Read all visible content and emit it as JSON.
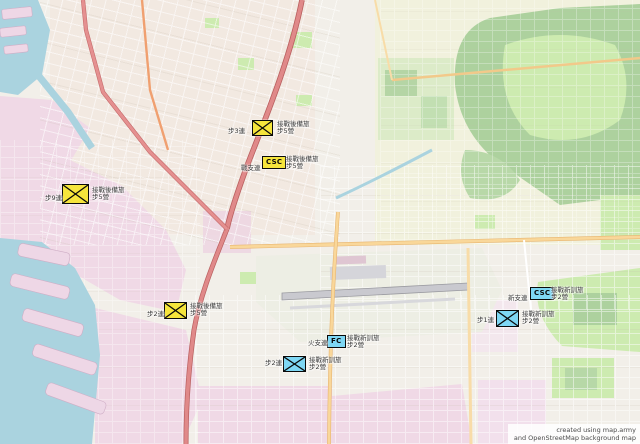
{
  "attribution": {
    "line1": "created using map.army",
    "line2": "and OpenStreetMap background map"
  },
  "legend_colors": {
    "reserve": "#f6e53c",
    "training": "#7ed7f4"
  },
  "markers": [
    {
      "id": "reserve-infantry-north",
      "symbol": "infantry",
      "group": "reserve",
      "x": 252,
      "y": 120,
      "w": 21,
      "h": 16,
      "unit": "步3連",
      "unit_x": 228,
      "unit_y": 128,
      "formation_line1": "接戰後備旅",
      "formation_line2": "步5營",
      "label_x": 277,
      "label_y": 121
    },
    {
      "id": "reserve-csc",
      "symbol": "badge",
      "badge": "CSC",
      "group": "reserve",
      "x": 262,
      "y": 156,
      "unit": "戰支連",
      "unit_x": 241,
      "unit_y": 165,
      "formation_line1": "接戰後備旅",
      "formation_line2": "步5營",
      "label_x": 286,
      "label_y": 156
    },
    {
      "id": "reserve-infantry-west",
      "symbol": "infantry",
      "group": "reserve",
      "x": 62,
      "y": 184,
      "w": 27,
      "h": 20,
      "unit": "步9連",
      "unit_x": 45,
      "unit_y": 195,
      "formation_line1": "接戰後備旅",
      "formation_line2": "步5營",
      "label_x": 92,
      "label_y": 187
    },
    {
      "id": "reserve-infantry-south",
      "symbol": "infantry",
      "group": "reserve",
      "x": 164,
      "y": 302,
      "w": 23,
      "h": 17,
      "unit": "步2連",
      "unit_x": 147,
      "unit_y": 311,
      "formation_line1": "接戰後備旅",
      "formation_line2": "步5營",
      "label_x": 190,
      "label_y": 303
    },
    {
      "id": "training-infantry-airport",
      "symbol": "infantry",
      "group": "training",
      "x": 283,
      "y": 356,
      "w": 23,
      "h": 16,
      "unit": "步2連",
      "unit_x": 265,
      "unit_y": 360,
      "formation_line1": "接戰新訓旅",
      "formation_line2": "步2營",
      "label_x": 309,
      "label_y": 357
    },
    {
      "id": "training-fc",
      "symbol": "badge",
      "badge": "FC",
      "group": "training",
      "x": 327,
      "y": 335,
      "unit": "火支連",
      "unit_x": 308,
      "unit_y": 340,
      "formation_line1": "接戰新訓旅",
      "formation_line2": "步2營",
      "label_x": 347,
      "label_y": 335
    },
    {
      "id": "training-csc",
      "symbol": "badge",
      "badge": "CSC",
      "group": "training",
      "x": 530,
      "y": 287,
      "unit": "新支連",
      "unit_x": 508,
      "unit_y": 295,
      "formation_line1": "接戰新訓旅",
      "formation_line2": "步2營",
      "label_x": 551,
      "label_y": 287
    },
    {
      "id": "training-infantry-east",
      "symbol": "infantry",
      "group": "training",
      "x": 496,
      "y": 310,
      "w": 23,
      "h": 17,
      "unit": "步1連",
      "unit_x": 477,
      "unit_y": 317,
      "formation_line1": "接戰新訓旅",
      "formation_line2": "步2營",
      "label_x": 522,
      "label_y": 311
    }
  ]
}
